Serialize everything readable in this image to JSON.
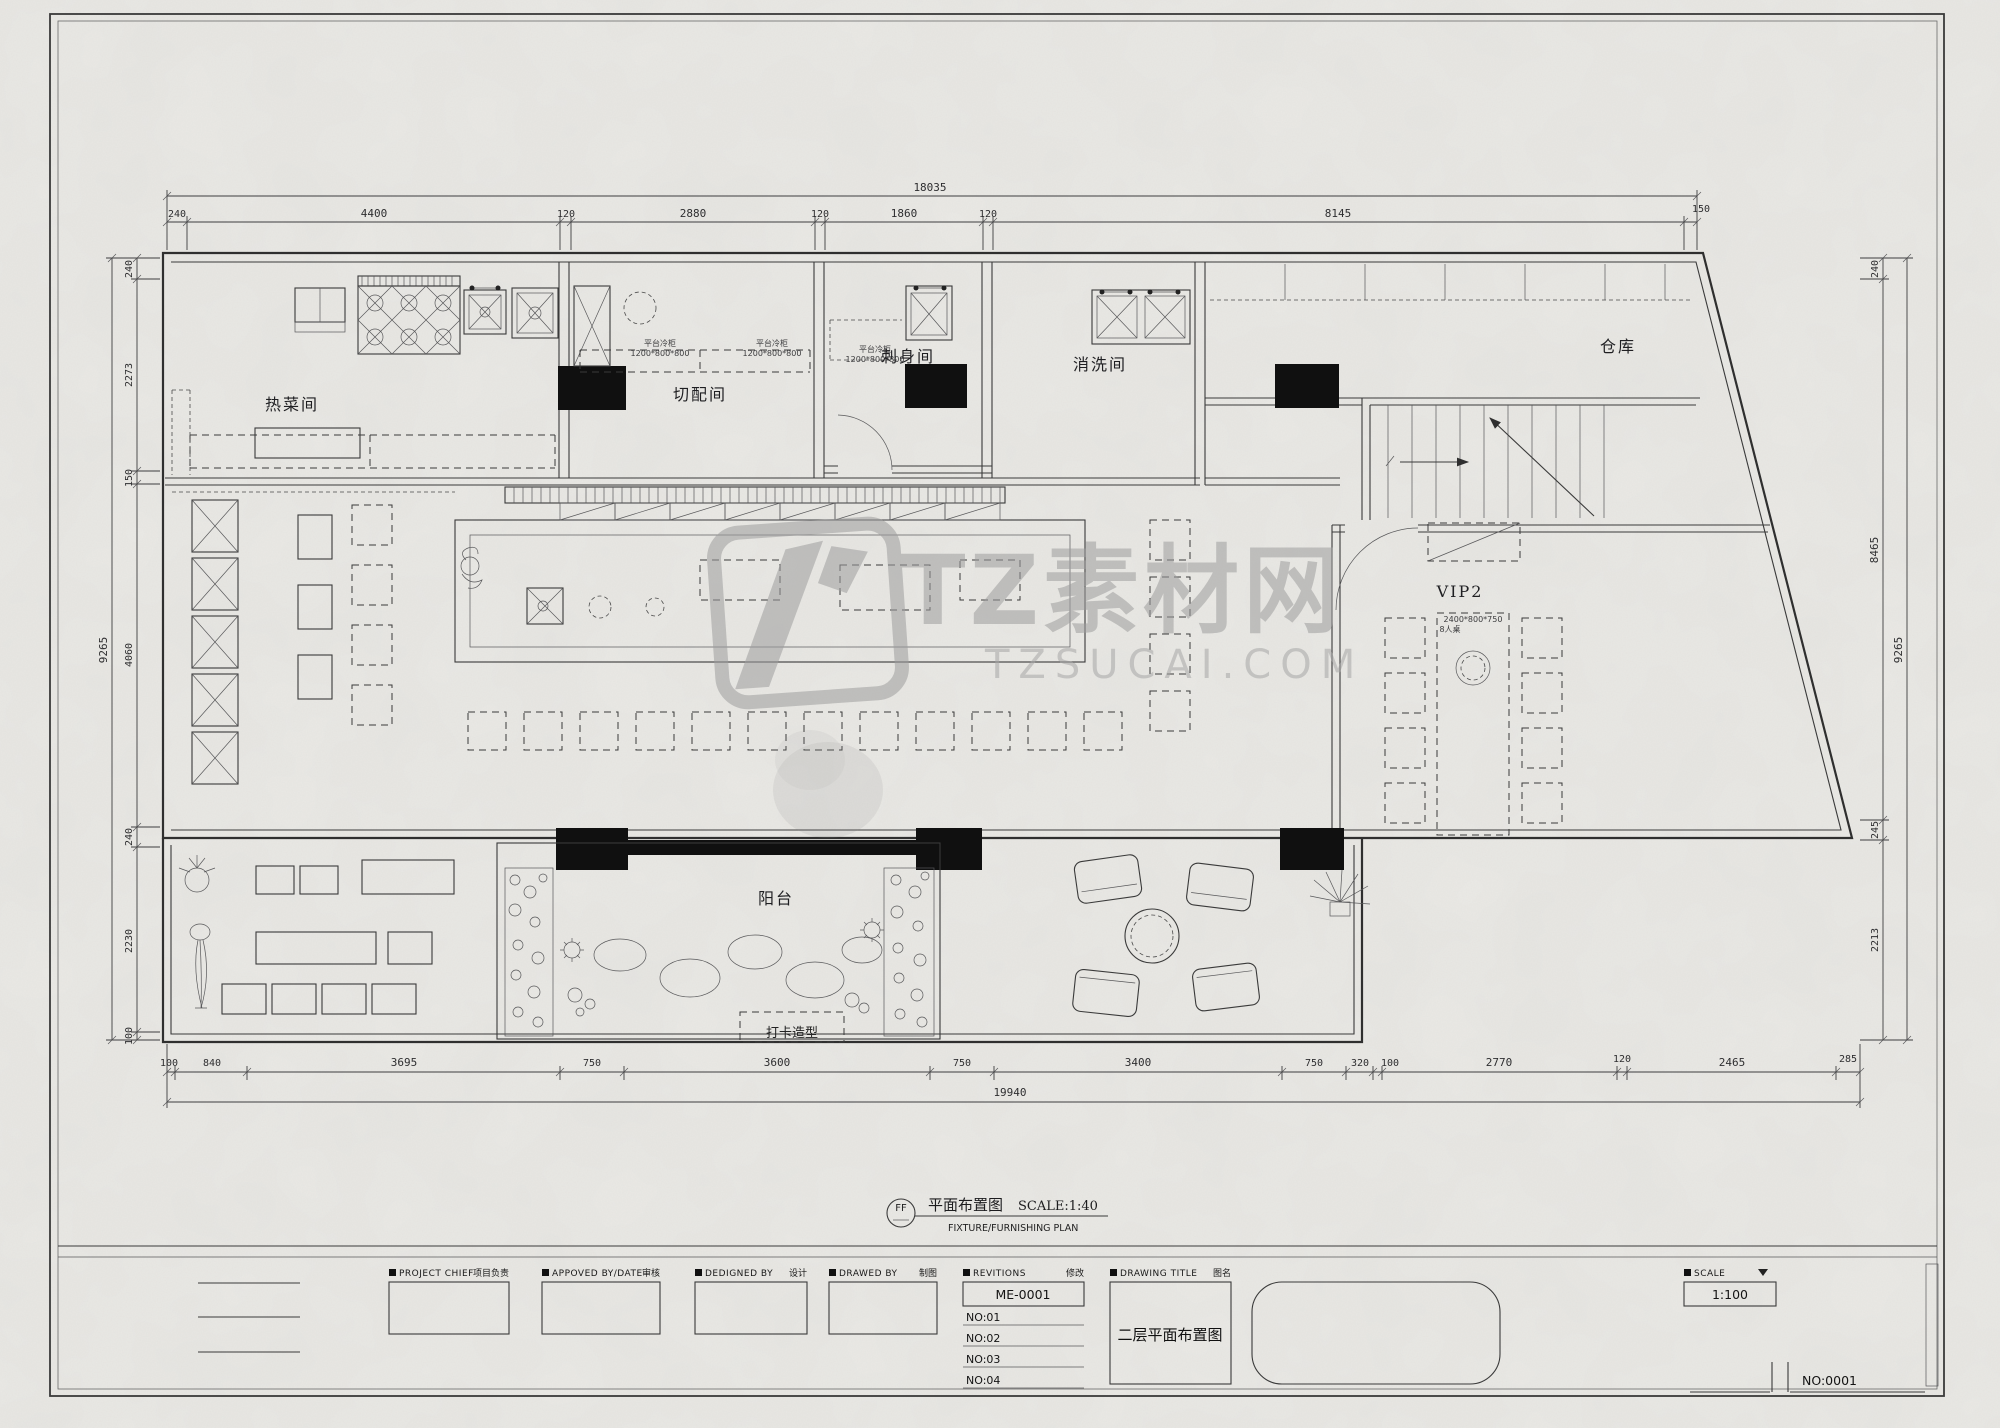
{
  "watermark": {
    "brand": "TZ素材网",
    "domain": "TZSUCAI.COM"
  },
  "rooms": {
    "hot_dish": "热菜间",
    "prep": "切配间",
    "sashimi": "刺身间",
    "washing": "消洗间",
    "storage": "仓库",
    "vip": "VIP2",
    "balcony": "阳台",
    "photo_spot": "打卡造型"
  },
  "equipment": {
    "cold_counter": "平台冷柜",
    "cold_counter_size": "1200*800*800",
    "vip_table_size": "2400*800*750",
    "vip_table_type": "8人桌"
  },
  "dimensions": {
    "top": {
      "total": "18035",
      "segments": [
        "240",
        "4400",
        "120",
        "2880",
        "120",
        "1860",
        "120",
        "8145",
        "150"
      ]
    },
    "bottom": {
      "total": "19940",
      "segments": [
        "100",
        "840",
        "3695",
        "750",
        "3600",
        "750",
        "3400",
        "750",
        "320",
        "100",
        "2770",
        "120",
        "2465",
        "285"
      ]
    },
    "left": {
      "overall": "9265",
      "segments": [
        "240",
        "2273",
        "150",
        "4060",
        "240",
        "2230",
        "100"
      ]
    },
    "right": {
      "overall": "9265",
      "segments": [
        "240",
        "8465",
        "245",
        "2213"
      ]
    }
  },
  "plan_label": {
    "symbol": "FF",
    "title": "平面布置图",
    "scale": "SCALE:1:40",
    "subtitle": "FIXTURE/FURNISHING PLAN"
  },
  "title_block": {
    "project_chief": {
      "en": "PROJECT CHIEF",
      "cn": "项目负责"
    },
    "approved": {
      "en": "APPOVED BY/DATE",
      "cn": "审核"
    },
    "designed": {
      "en": "DEDIGNED BY",
      "cn": "设计"
    },
    "drawed": {
      "en": "DRAWED BY",
      "cn": "制图"
    },
    "revisions": {
      "en": "REVITIONS",
      "cn": "修改",
      "code": "ME-0001",
      "items": [
        "NO:01",
        "NO:02",
        "NO:03",
        "NO:04"
      ]
    },
    "drawing_title": {
      "en": "DRAWING TITLE",
      "cn": "图名",
      "value": "二层平面布置图"
    },
    "scale": {
      "en": "SCALE",
      "cn": "比例",
      "value": "1:100"
    },
    "sheet_no": "NO:0001"
  }
}
